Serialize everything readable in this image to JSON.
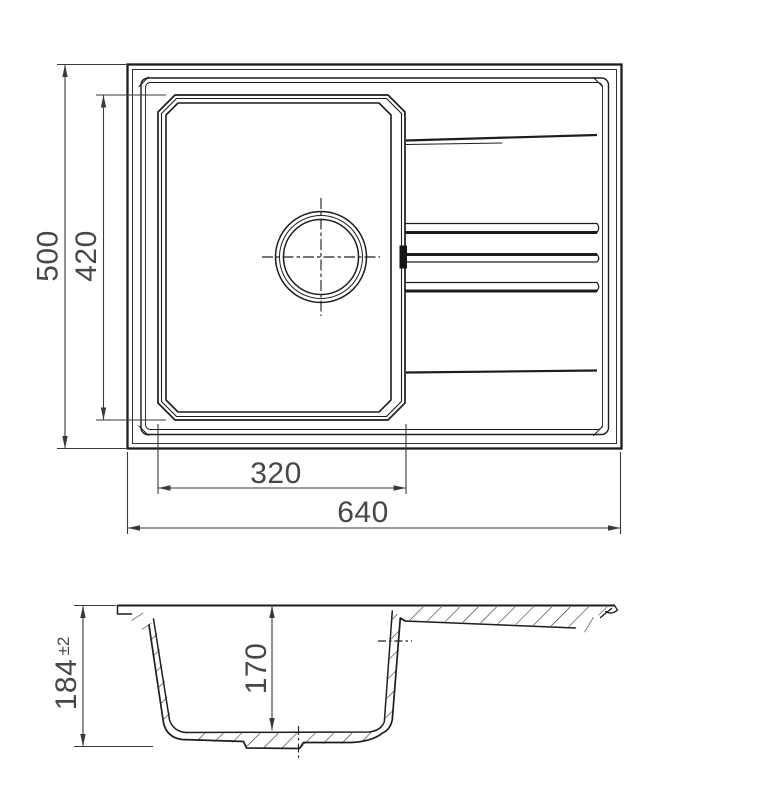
{
  "drawing": {
    "background": "#ffffff",
    "line_color": "#1d1d1d",
    "dimension_color": "#3a3a3a",
    "text_color": "#474747"
  },
  "dimensions": {
    "overall_depth": "500",
    "bowl_depth": "420",
    "bowl_width": "320",
    "overall_width": "640",
    "overall_height": "184",
    "overall_height_tolerance": "±2",
    "bowl_inner_depth": "170"
  }
}
